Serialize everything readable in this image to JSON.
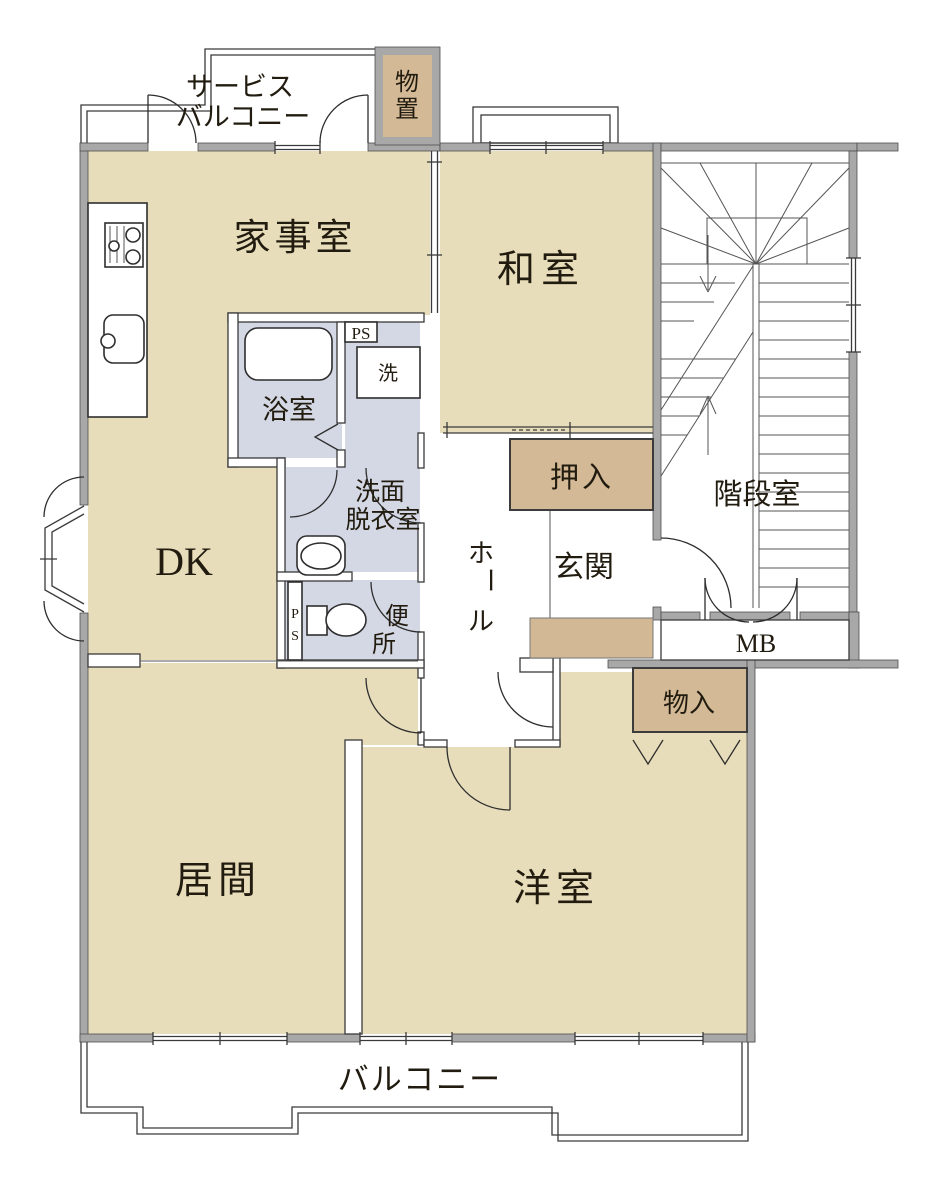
{
  "colors": {
    "room_tan": "#e8ddba",
    "closet_tan": "#d3b995",
    "step_tan": "#d2b894",
    "wet_blue": "#d4d8e4",
    "wall_gray": "#a8a8a8",
    "line": "#3a3a3a"
  },
  "rooms": {
    "service_balcony": {
      "label_line1": "サービス",
      "label_line2": "バルコニー"
    },
    "storage_top": {
      "chars": [
        "物",
        "置"
      ]
    },
    "utility": {
      "label": "家事室"
    },
    "japanese_room": {
      "label": "和室"
    },
    "stairwell": {
      "label": "階段室"
    },
    "bathroom": {
      "label": "浴室"
    },
    "washer": {
      "label": "洗"
    },
    "washroom": {
      "label_line1": "洗面",
      "label_line2": "脱衣室"
    },
    "toilet": {
      "chars": [
        "便",
        "所"
      ]
    },
    "dk": {
      "label": "DK"
    },
    "hall": {
      "chars": [
        "ホ",
        "ー",
        "ル"
      ]
    },
    "entrance": {
      "label": "玄関"
    },
    "oshiire": {
      "label": "押入"
    },
    "monoire": {
      "label": "物入"
    },
    "living": {
      "label": "居間"
    },
    "western_room": {
      "label": "洋室"
    },
    "balcony": {
      "label": "バルコニー"
    },
    "meter_box": {
      "label": "MB"
    },
    "ps_upper": {
      "label": "PS"
    },
    "ps_lower": {
      "chars": [
        "P",
        "S"
      ]
    }
  }
}
